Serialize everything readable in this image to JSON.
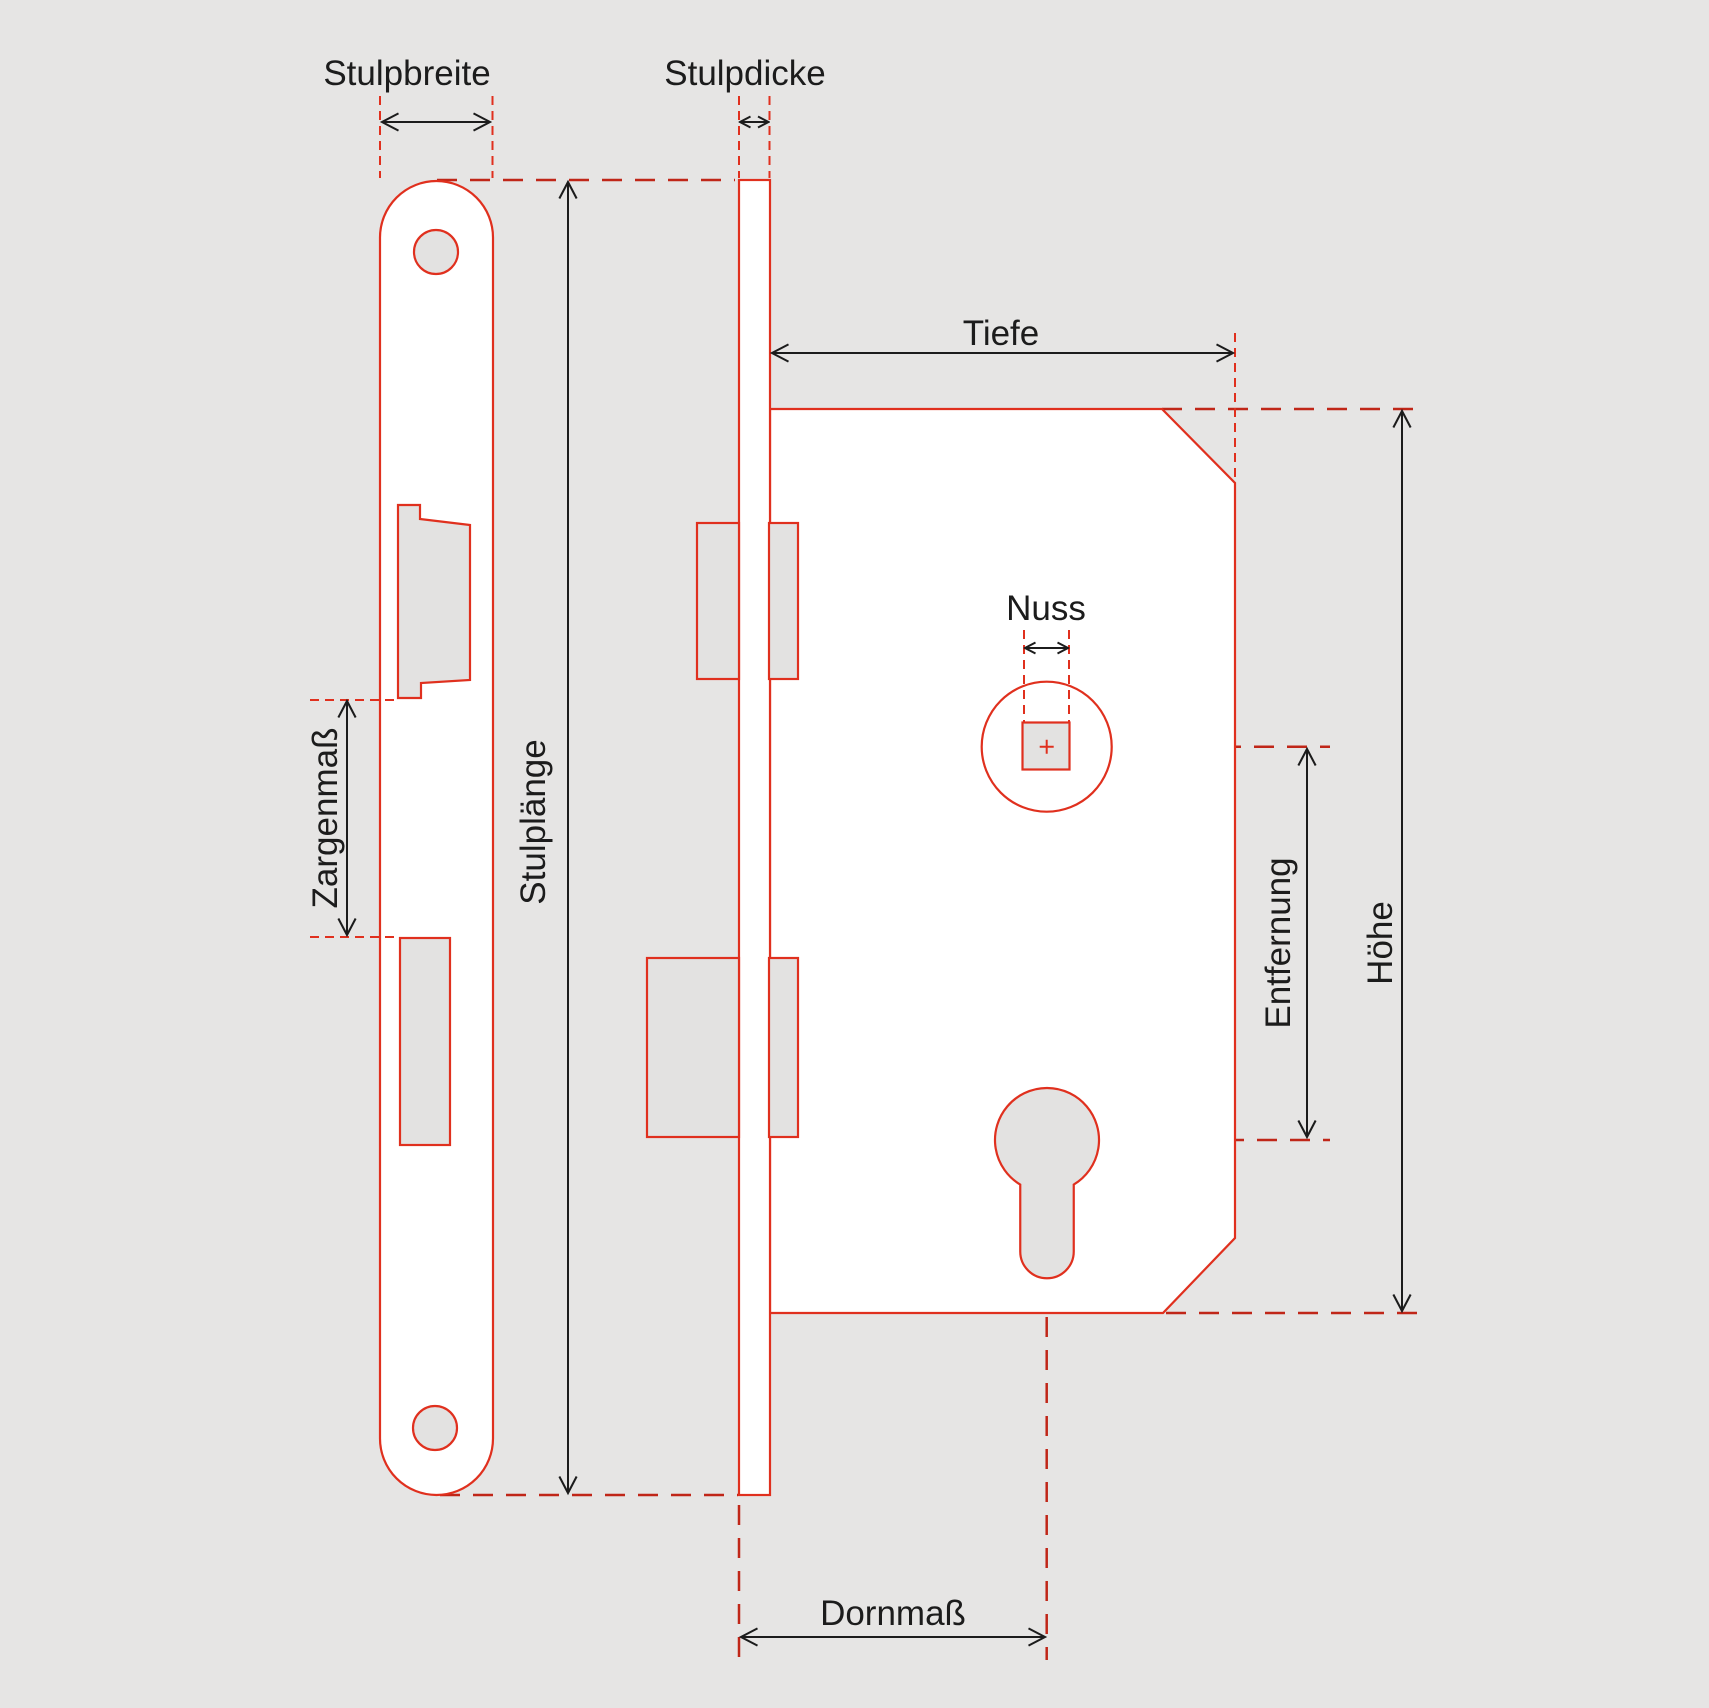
{
  "diagram": {
    "type": "technical-drawing",
    "subject": "Mortise lock dimension diagram",
    "labels": {
      "stulpbreite": "Stulpbreite",
      "stulpdicke": "Stulpdicke",
      "stulplaenge": "Stulplänge",
      "zargenmass": "Zargenmaß",
      "tiefe": "Tiefe",
      "nuss": "Nuss",
      "entfernung": "Entfernung",
      "hoehe": "Höhe",
      "dornmass": "Dornmaß"
    }
  },
  "colors": {
    "background": "#e6e5e4",
    "shape_fill": "#ffffff",
    "cutout_fill": "#e3e2e1",
    "outline_red": "#e0301e",
    "ext_red": "#e0301e",
    "ref_red": "#c02618",
    "dim_black": "#1c1c1c"
  }
}
